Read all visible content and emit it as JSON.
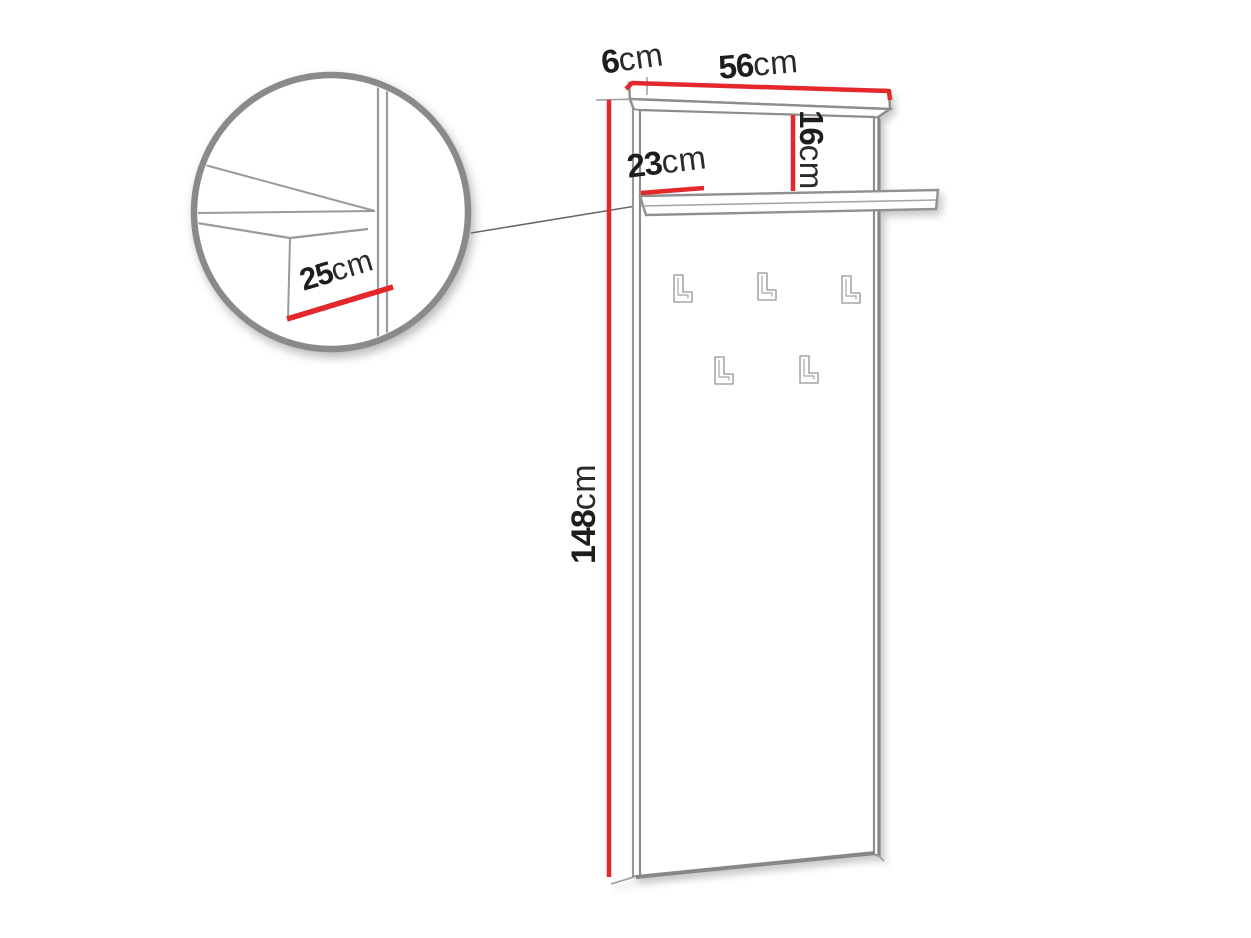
{
  "diagram": {
    "type": "furniture-dimension-drawing",
    "subject": "wall coat-rack panel with top shelf and hooks",
    "hook_count": 5,
    "colors": {
      "dimension_line": "#e4272b",
      "outline_gray": "#8d8d8d",
      "label_text": "#1d1d1d"
    },
    "dimensions": {
      "depth": {
        "num": "6",
        "unit": "cm"
      },
      "width": {
        "num": "56",
        "unit": "cm"
      },
      "shelf_drop": {
        "num": "16",
        "unit": "cm"
      },
      "shelf_offset": {
        "num": "23",
        "unit": "cm"
      },
      "height": {
        "num": "148",
        "unit": "cm"
      },
      "shelf_depth": {
        "num": "25",
        "unit": "cm"
      }
    }
  }
}
